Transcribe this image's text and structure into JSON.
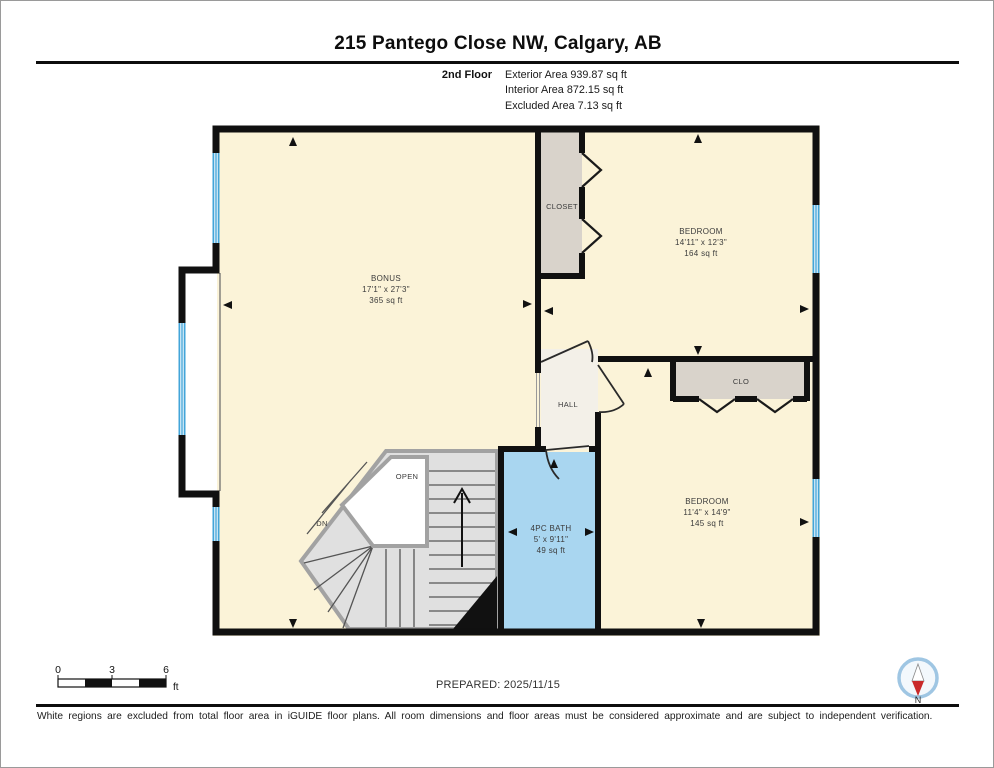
{
  "title": "215 Pantego Close NW, Calgary, AB",
  "floor": {
    "label": "2nd Floor",
    "exterior": "Exterior Area 939.87 sq ft",
    "interior": "Interior Area 872.15 sq ft",
    "excluded": "Excluded Area 7.13 sq ft"
  },
  "rooms": {
    "bonus": {
      "name": "BONUS",
      "dims": "17'1\" x 27'3\"",
      "area": "365 sq ft"
    },
    "bedroom_top": {
      "name": "BEDROOM",
      "dims": "14'11\" x 12'3\"",
      "area": "164 sq ft"
    },
    "bedroom_bottom": {
      "name": "BEDROOM",
      "dims": "11'4\" x 14'9\"",
      "area": "145 sq ft"
    },
    "bath": {
      "name": "4PC BATH",
      "dims": "5' x 9'11\"",
      "area": "49 sq ft"
    },
    "closet": {
      "name": "CLOSET"
    },
    "clo": {
      "name": "CLO"
    },
    "hall": {
      "name": "HALL"
    },
    "open": {
      "name": "OPEN"
    },
    "stairs": {
      "name": "DN"
    }
  },
  "scale_bar": {
    "tick0": "0",
    "tick1": "3",
    "tick2": "6",
    "unit": "ft"
  },
  "prepared": "PREPARED: 2025/11/15",
  "compass": {
    "north_label": "N"
  },
  "disclaimer": "White regions are excluded from total floor area in iGUIDE floor plans. All room dimensions and floor areas must be considered approximate and are subject to independent verification.",
  "colors": {
    "wall": "#101010",
    "room_fill": "#FBF3D8",
    "closet_fill": "#D9D3CB",
    "bath_fill": "#A9D6F0",
    "window_blue": "#43A5D9",
    "stair_fill": "#E0E0E0",
    "stair_band": "#A2A2A2",
    "excluded_white": "#FFFFFF",
    "compass_ring": "#9FC6E3",
    "compass_red": "#C92A2A"
  }
}
